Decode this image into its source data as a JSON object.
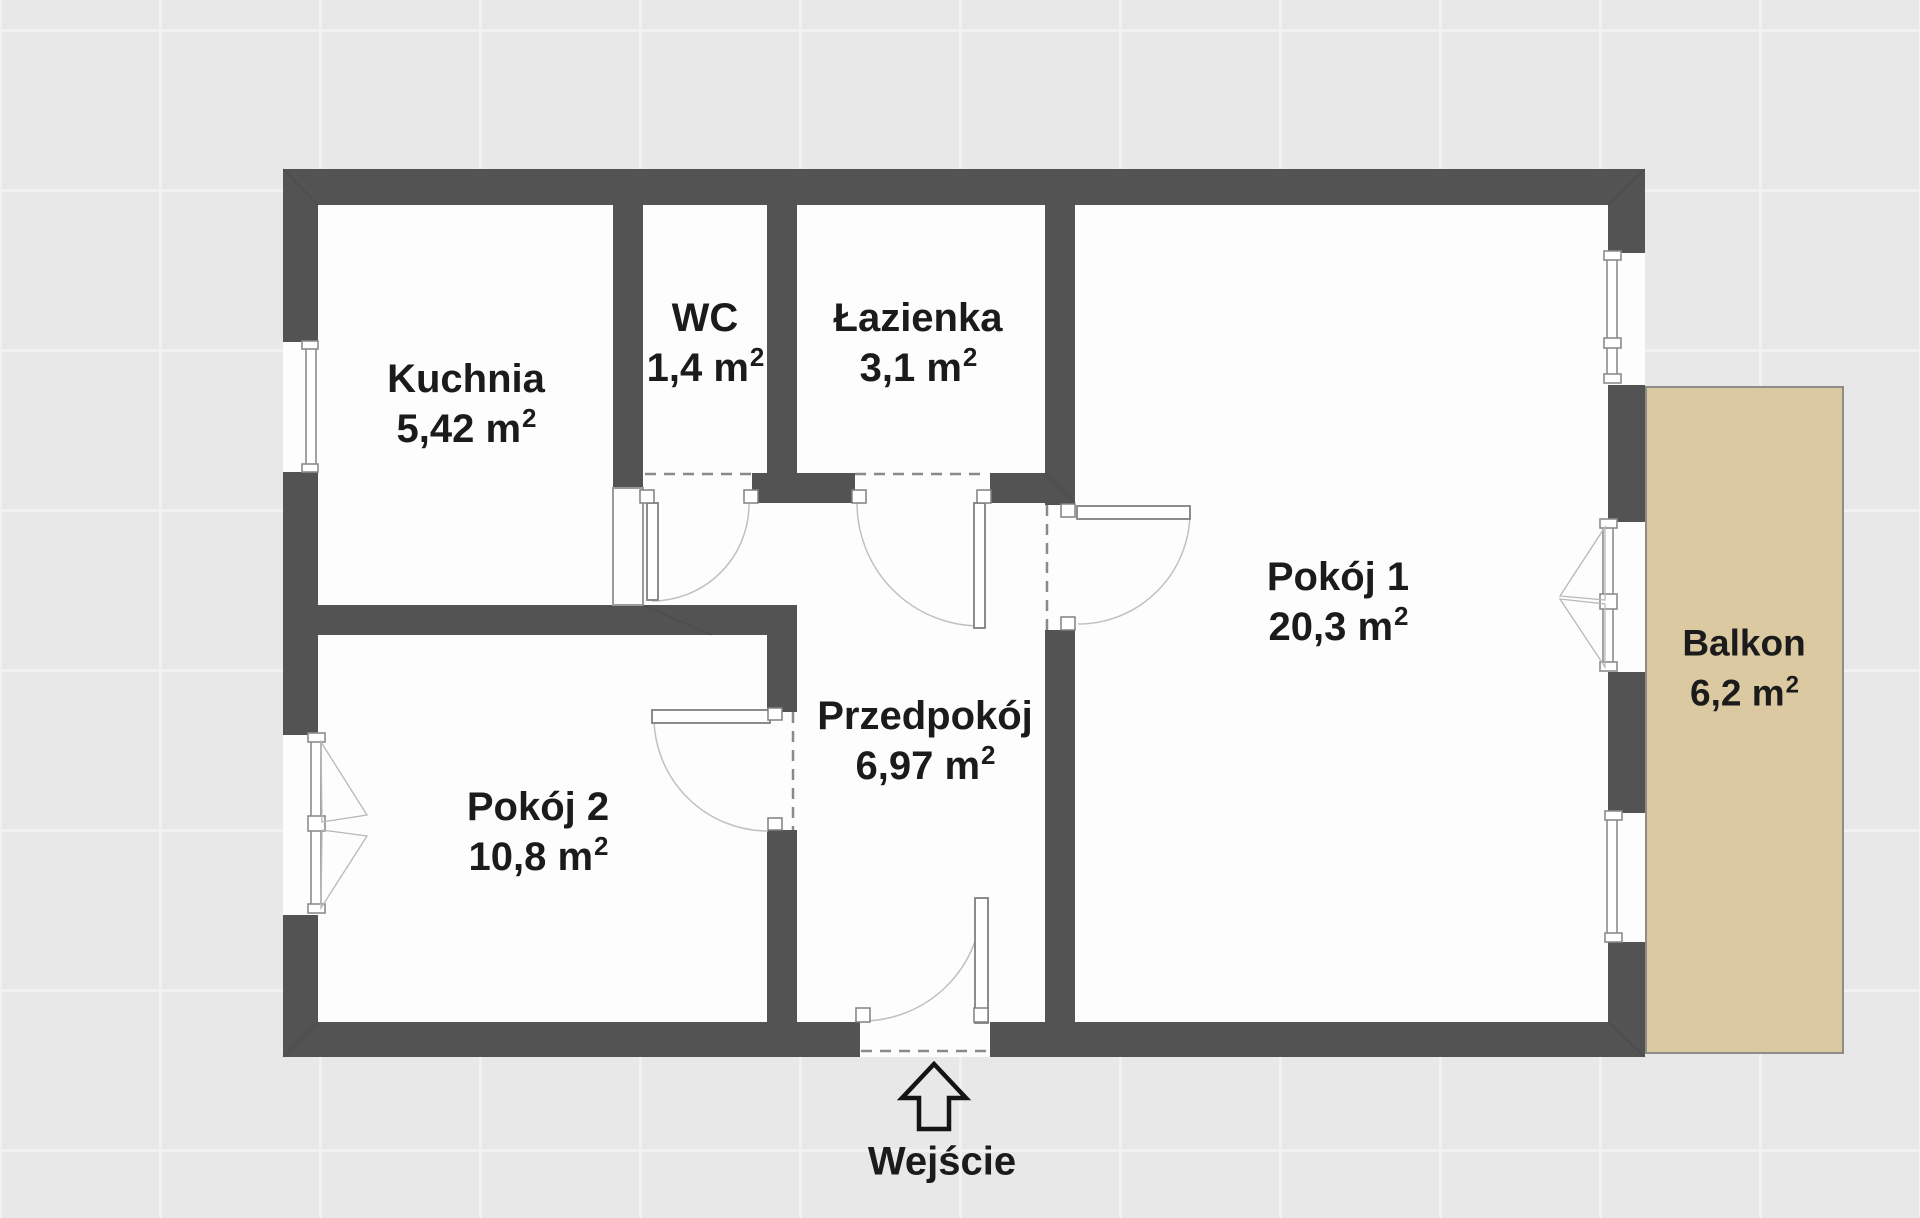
{
  "rooms": [
    {
      "id": "kuchnia",
      "name": "Kuchnia",
      "area": "5,42 m",
      "sup": "2"
    },
    {
      "id": "wc",
      "name": "WC",
      "area": "1,4 m",
      "sup": "2"
    },
    {
      "id": "lazienka",
      "name": "Łazienka",
      "area": "3,1 m",
      "sup": "2"
    },
    {
      "id": "pokoj-1",
      "name": "Pokój 1",
      "area": "20,3 m",
      "sup": "2"
    },
    {
      "id": "pokoj-2",
      "name": "Pokój 2",
      "area": "10,8 m",
      "sup": "2"
    },
    {
      "id": "przedpokoj",
      "name": "Przedpokój",
      "area": "6,97 m",
      "sup": "2"
    },
    {
      "id": "balkon",
      "name": "Balkon",
      "area": "6,2 m",
      "sup": "2"
    }
  ],
  "entrance": {
    "label": "Wejście"
  },
  "colors": {
    "wall": "#535353",
    "floor": "#fdfdfd",
    "balcony_fill": "#dbc9a1",
    "balcony_border": "#8d8d85",
    "background": "#e8e8e8",
    "dash_line": "#8a8a8a",
    "door_arc": "#c0c0c0",
    "text": "#1b1b1b"
  }
}
